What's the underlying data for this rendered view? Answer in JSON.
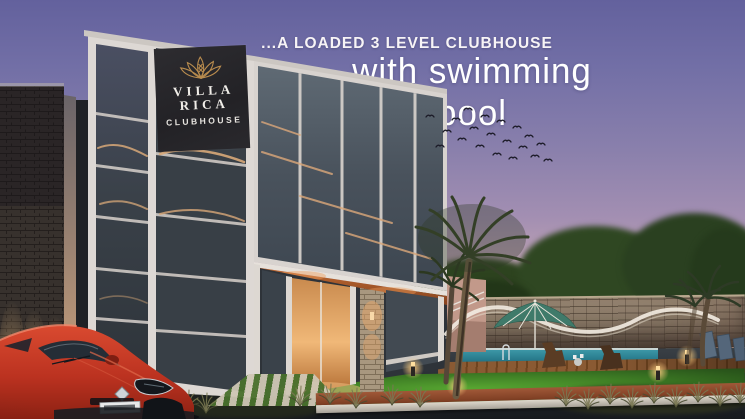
{
  "headline": {
    "line1": "...A LOADED 3 LEVEL CLUBHOUSE",
    "line2": "with swimming pool",
    "text_color": "#f7f4f6"
  },
  "signage": {
    "logo": "gold-lotus-icon",
    "logo_color": "#b98c4e",
    "name_line1": "VILLA",
    "name_line2": "RICA",
    "subtitle": "CLUBHOUSE",
    "text_color": "#f0ede8",
    "panel_color": "#262529"
  },
  "scene": {
    "time_of_day": "dusk",
    "colors": {
      "sky_top": "#63619d",
      "sky_horizon": "#f2c3ae",
      "glass": "#49525c",
      "stone_dark": "#37312d",
      "stone_tan": "#9d8c76",
      "pool_water": "#1f6f80",
      "lawn_lit": "#57a631",
      "deck_wood": "#8a5a33",
      "soffit_orange": "#b86630",
      "car_red": "#c03424",
      "warm_light": "#e8b06a"
    },
    "features": [
      {
        "name": "glass-clubhouse-building",
        "label": "3-level glass clubhouse"
      },
      {
        "name": "entrance-canopy",
        "label": "Lit entrance with orange soffit"
      },
      {
        "name": "stone-boundary-wall",
        "label": "Stacked-stone compound wall"
      },
      {
        "name": "swimming-pool",
        "label": "Swimming pool"
      },
      {
        "name": "pool-umbrella",
        "label": "Teal pool umbrella"
      },
      {
        "name": "lounge-chairs",
        "label": "Poolside lounge chairs"
      },
      {
        "name": "wooden-deck",
        "label": "Timber pool deck"
      },
      {
        "name": "lawn",
        "label": "Landscaped lawn"
      },
      {
        "name": "palm-trees",
        "label": "Palm trees"
      },
      {
        "name": "birds-flock",
        "label": "Flock of birds in sunset sky"
      },
      {
        "name": "bollard-lights",
        "label": "Warm bollard garden lights"
      },
      {
        "name": "red-car",
        "label": "Red hatchback parked at entrance"
      }
    ]
  }
}
